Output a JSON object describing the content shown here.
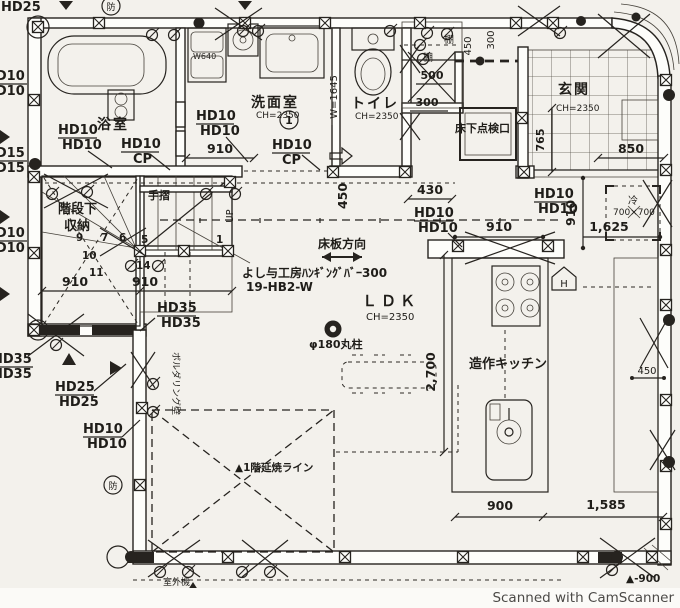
{
  "watermark": "Scanned with CamScanner",
  "rooms": {
    "bathroom": "浴室",
    "washroom": "洗面室",
    "washroom_ch": "CH=2350",
    "toilet": "トイレ",
    "toilet_ch": "CH=2350",
    "entrance": "玄関",
    "entrance_ch": "CH=2350",
    "ldk": "ＬＤＫ",
    "ldk_ch": "CH=2350",
    "kitchen": "造作キッチン",
    "stair_storage_1": "階段下",
    "stair_storage_2": "収納",
    "inspection_hatch": "床下点検口",
    "fridge": "冷",
    "fridge_size": "700×700"
  },
  "annotations": {
    "floor_direction": "床板方向",
    "hanging_bar": "よし与工房ﾊﾝｷﾞﾝｸﾞﾊﾞｰ300",
    "hanging_bar_model": "19-HB2-W",
    "column": "φ180丸柱",
    "fire_line": "▲1階延焼ライン",
    "outdoor_unit": "室外機",
    "handrail": "手摺",
    "shelf_top": "棚",
    "shelf_side": "棚",
    "bouldering_wall": "ボルダリング壁",
    "circled_one": "1",
    "fire_mark_top": "防",
    "fire_mark_left": "防",
    "up": "UP",
    "level_mark": "▲-900",
    "basin_width": "W640",
    "opening_width": "W=1645",
    "hood_mark": "H"
  },
  "dimensions": {
    "d910_wash": "910",
    "d910_stair_l": "910",
    "d910_stair_r": "910",
    "d910_ldk_h": "910",
    "d910_ldk_v": "910",
    "d430": "430",
    "d450_toilet": "450",
    "d450_shelf": "450",
    "d450_wall": "450",
    "d300_shelf_v": "300",
    "d300_shelf": "300",
    "d500_shelf": "500",
    "d765": "765",
    "d850": "850",
    "d1625": "1,625",
    "d2700": "2,700",
    "d900": "900",
    "d1585": "1,585"
  },
  "hold_downs": {
    "hd25_corner": "HD25",
    "edge10a_1": "HD10",
    "edge10a_2": "HD10",
    "edge15_1": "HD15",
    "edge15_2": "HD15",
    "edge10b_1": "HD10",
    "edge10b_2": "HD10",
    "edge35_1": "HD35",
    "edge35_2": "HD35",
    "bath_1": "HD10",
    "bath_2": "HD10",
    "bath_cp_1": "HD10",
    "bath_cp_2": "CP",
    "wash_1": "HD10",
    "wash_2": "HD10",
    "wash_cp_1": "HD10",
    "wash_cp_2": "CP",
    "stair_1": "HD35",
    "stair_2": "HD35",
    "mid_1": "HD25",
    "mid_2": "HD25",
    "low_1": "HD10",
    "low_2": "HD10",
    "ldk_1": "HD10",
    "ldk_2": "HD10",
    "hall_1": "HD10",
    "hall_2": "HD10"
  },
  "stair_steps": {
    "s1": "1",
    "s5": "5",
    "s6": "6",
    "s7": "7",
    "s9": "9",
    "s10": "10",
    "s11": "11",
    "s14": "14"
  },
  "colors": {
    "ink": "#26231f",
    "paper": "#f3f1ec",
    "watermark_gray": "#4c4a47"
  }
}
